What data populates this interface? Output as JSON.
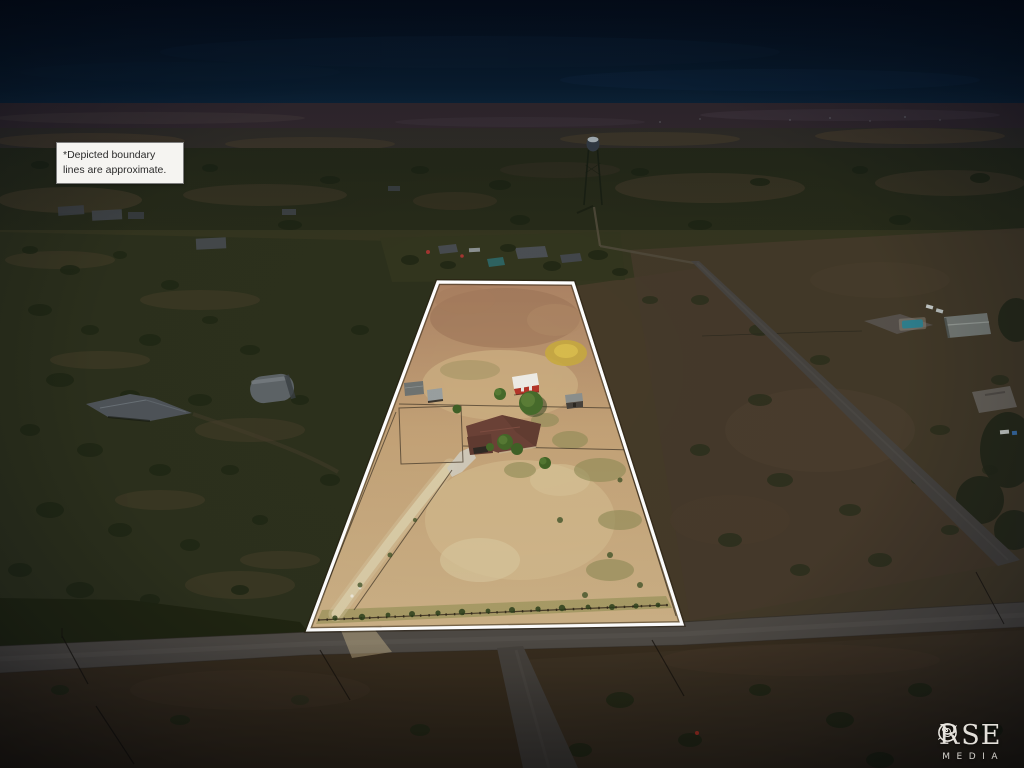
{
  "overlay": {
    "disclaimer": {
      "line1": "*Depicted boundary",
      "line2": "lines are approximate."
    }
  },
  "watermark": {
    "brand": "ROSE",
    "subtitle": "MEDIA"
  },
  "scene": {
    "visible_features": [
      "white property boundary outline",
      "farm house with brown roof",
      "red barn with white roof",
      "storage sheds",
      "dirt driveway",
      "paved county road with intersection",
      "water tower on horizon",
      "neighboring rural homes",
      "scrub brushland"
    ]
  },
  "palette": {
    "sky_top": "#050e1b",
    "sky_mid": "#0a2135",
    "sky_horizon": "#16344e",
    "horizon_band": "#382c31",
    "distant_plain": "#343029",
    "scrub_band": "#272b19",
    "ground_base": "#34351f",
    "left_scrub": "#2c301c",
    "right_field": "#45392a",
    "bottom_field": "#382d1e",
    "road_gray": "#4d4944",
    "parcel_top": "#ab8263",
    "parcel_mid": "#c2a176",
    "parcel_low": "#ccb186",
    "sand_light": "#d9c89f",
    "green_patch": "#8e8a55",
    "yellow_patch": "#c6a83f",
    "dirt_path": "#d9cba6",
    "concrete": "#cfc9ba",
    "house_roof": "#6a4136",
    "barn_roof": "#eceae4",
    "barn_red": "#b23529",
    "shed_roof": "#989e9e",
    "tree_green": "#466a2b",
    "pool_teal": "#2f7f8d",
    "boundary_white": "#ffffff"
  }
}
